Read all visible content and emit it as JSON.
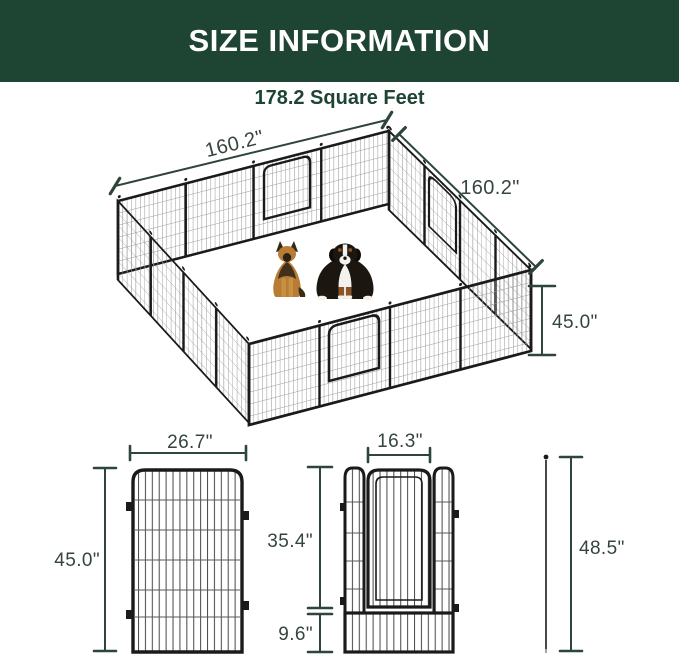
{
  "header": {
    "title": "SIZE INFORMATION"
  },
  "subtitle": "178.2 Square Feet",
  "colors": {
    "header_bg": "#1e4433",
    "header_text": "#ffffff",
    "dimension_lines": "#2e453a",
    "dimension_text": "#36453c",
    "frame_black": "#1a1a1a"
  },
  "pen_diagram": {
    "back_left_width": "160.2\"",
    "back_right_depth": "160.2\"",
    "panel_height": "45.0\""
  },
  "panel_diagram": {
    "width": "26.7\"",
    "height": "45.0\""
  },
  "door_panel_diagram": {
    "door_width": "16.3\"",
    "door_height": "35.4\"",
    "bottom_height": "9.6\""
  },
  "stake_diagram": {
    "height": "48.5\""
  }
}
